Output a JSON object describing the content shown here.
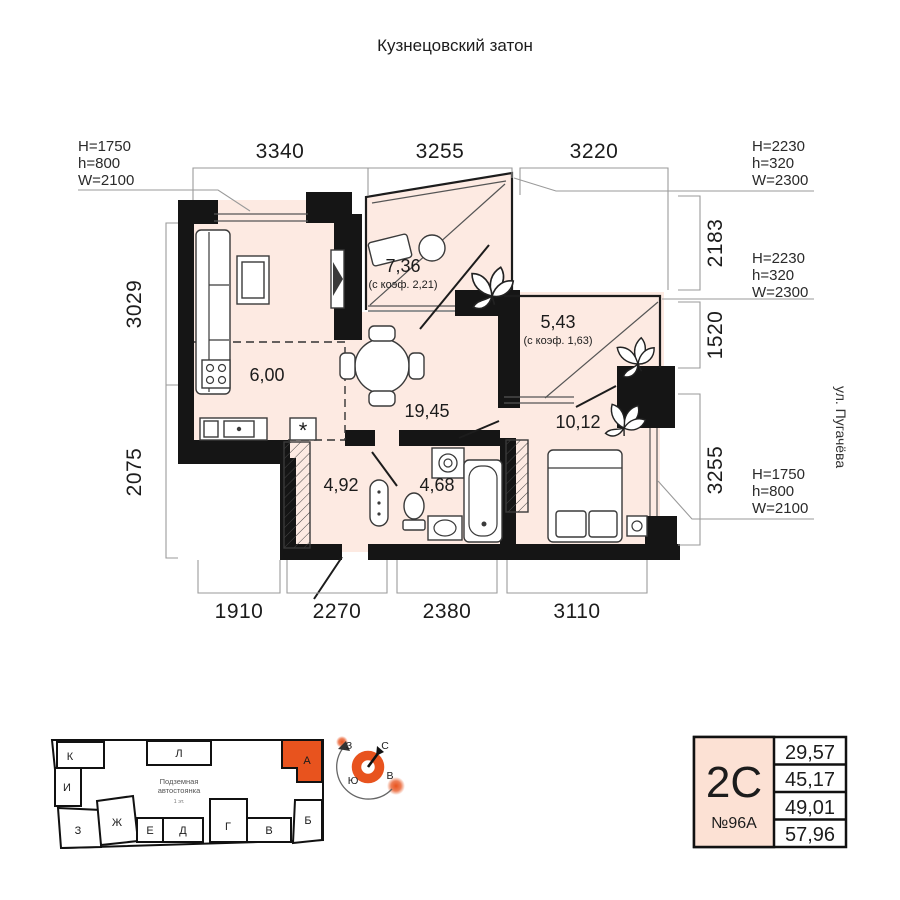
{
  "title": "Кузнецовский затон",
  "street_label": "ул. Пугачёва",
  "plan": {
    "rooms": [
      {
        "id": "balcony-736",
        "area": "7,36",
        "coef": "(с коэф. 2,21)"
      },
      {
        "id": "balcony-543",
        "area": "5,43",
        "coef": "(с коэф. 1,63)"
      },
      {
        "id": "kitchen",
        "area": "6,00"
      },
      {
        "id": "living-dining",
        "area": "19,45"
      },
      {
        "id": "bedroom",
        "area": "10,12"
      },
      {
        "id": "hall",
        "area": "4,92"
      },
      {
        "id": "bathroom",
        "area": "4,68"
      }
    ],
    "dimensions": {
      "top": [
        "3340",
        "3255",
        "3220"
      ],
      "bottom": [
        "1910",
        "2270",
        "2380",
        "3110"
      ],
      "left": [
        "3029",
        "2075"
      ],
      "right": [
        "2183",
        "1520",
        "3255"
      ]
    },
    "window_specs": [
      {
        "id": "top-left",
        "lines": [
          "H=1750",
          "h=800",
          "W=2100"
        ]
      },
      {
        "id": "right-top",
        "lines": [
          "H=2230",
          "h=320",
          "W=2300"
        ]
      },
      {
        "id": "right-middle",
        "lines": [
          "H=2230",
          "h=320",
          "W=2300"
        ]
      },
      {
        "id": "right-bottom",
        "lines": [
          "H=1750",
          "h=800",
          "W=2100"
        ]
      }
    ]
  },
  "site_plan": {
    "underground_label_line1": "Подземная",
    "underground_label_line2": "автостоянка",
    "underground_sublabel": "1 эт.",
    "highlighted_block": "А",
    "blocks": [
      {
        "letter": "К"
      },
      {
        "letter": "И"
      },
      {
        "letter": "З"
      },
      {
        "letter": "Ж"
      },
      {
        "letter": "Е"
      },
      {
        "letter": "Д"
      },
      {
        "letter": "Г"
      },
      {
        "letter": "В"
      },
      {
        "letter": "Б"
      },
      {
        "letter": "Л"
      },
      {
        "letter": "А"
      }
    ]
  },
  "compass": {
    "north": "С",
    "east": "В",
    "south": "Ю",
    "west": "З"
  },
  "info_card": {
    "plan_type": "2С",
    "apartment_number": "№96А",
    "areas": [
      "29,57",
      "45,17",
      "49,01",
      "57,96"
    ]
  },
  "colors": {
    "accent_orange": "#e8531e",
    "room_fill": "#fdeae2",
    "card_cell_fill": "#fce1d4",
    "wall_black": "#151515"
  }
}
